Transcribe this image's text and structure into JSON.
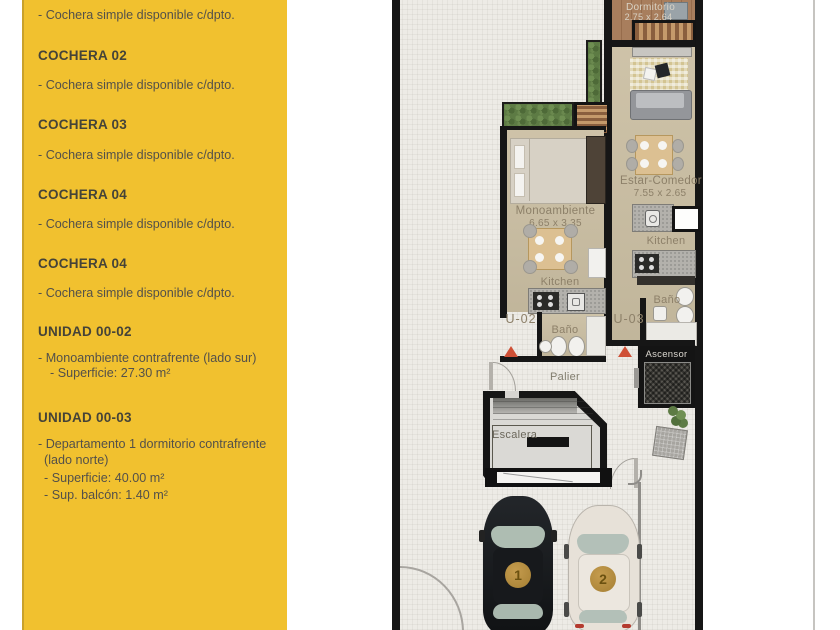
{
  "sidebar": {
    "bg_color": "#f1c12f",
    "intro_line": "- Cochera simple disponible c/dpto.",
    "sections": [
      {
        "title": "COCHERA 02",
        "lines": [
          "- Cochera simple disponible c/dpto."
        ]
      },
      {
        "title": "COCHERA 03",
        "lines": [
          "- Cochera simple disponible c/dpto."
        ]
      },
      {
        "title": "COCHERA 04",
        "lines": [
          "- Cochera simple disponible c/dpto."
        ]
      },
      {
        "title": "COCHERA 04",
        "lines": [
          "- Cochera simple disponible c/dpto."
        ]
      },
      {
        "title": "UNIDAD  00-02",
        "lines": [
          "- Monoambiente contrafrente (lado sur)",
          "- Superficie: 27.30 m²"
        ]
      },
      {
        "title": "UNIDAD 00-03",
        "lines": [
          "- Departamento 1 dormitorio contrafrente",
          "(lado norte)",
          "- Superficie: 40.00 m²",
          "- Sup. balcón: 1.40 m²"
        ]
      }
    ]
  },
  "plan": {
    "labels": {
      "dormitorio": "Dormitorio",
      "dormitorio_dims": "2.75 x 2.64",
      "estar_comedor": "Estar-Comedor",
      "estar_comedor_dims": "7.55 x 2.65",
      "monoambiente": "Monoambiente",
      "monoambiente_dims": "6.65 x 3.35",
      "kitchen_u02": "Kitchen",
      "kitchen_u03": "Kitchen",
      "bano_u02": "Baño",
      "bano_u03": "Baño",
      "unit_u02": "U-02",
      "unit_u03": "U-03",
      "palier": "Palier",
      "escalera": "Escalera",
      "ascensor": "Ascensor"
    },
    "cars": [
      {
        "number": "1",
        "body_color": "#1b1d20"
      },
      {
        "number": "2",
        "body_color": "#e7e1d8"
      }
    ],
    "colors": {
      "wall": "#161616",
      "floor_beige": "#cbbfa3",
      "wood": "#a87e5d",
      "hedge_green": "#5d7b44",
      "badge_gold": "#b18a3e",
      "label_taupe": "#8d8069"
    }
  }
}
